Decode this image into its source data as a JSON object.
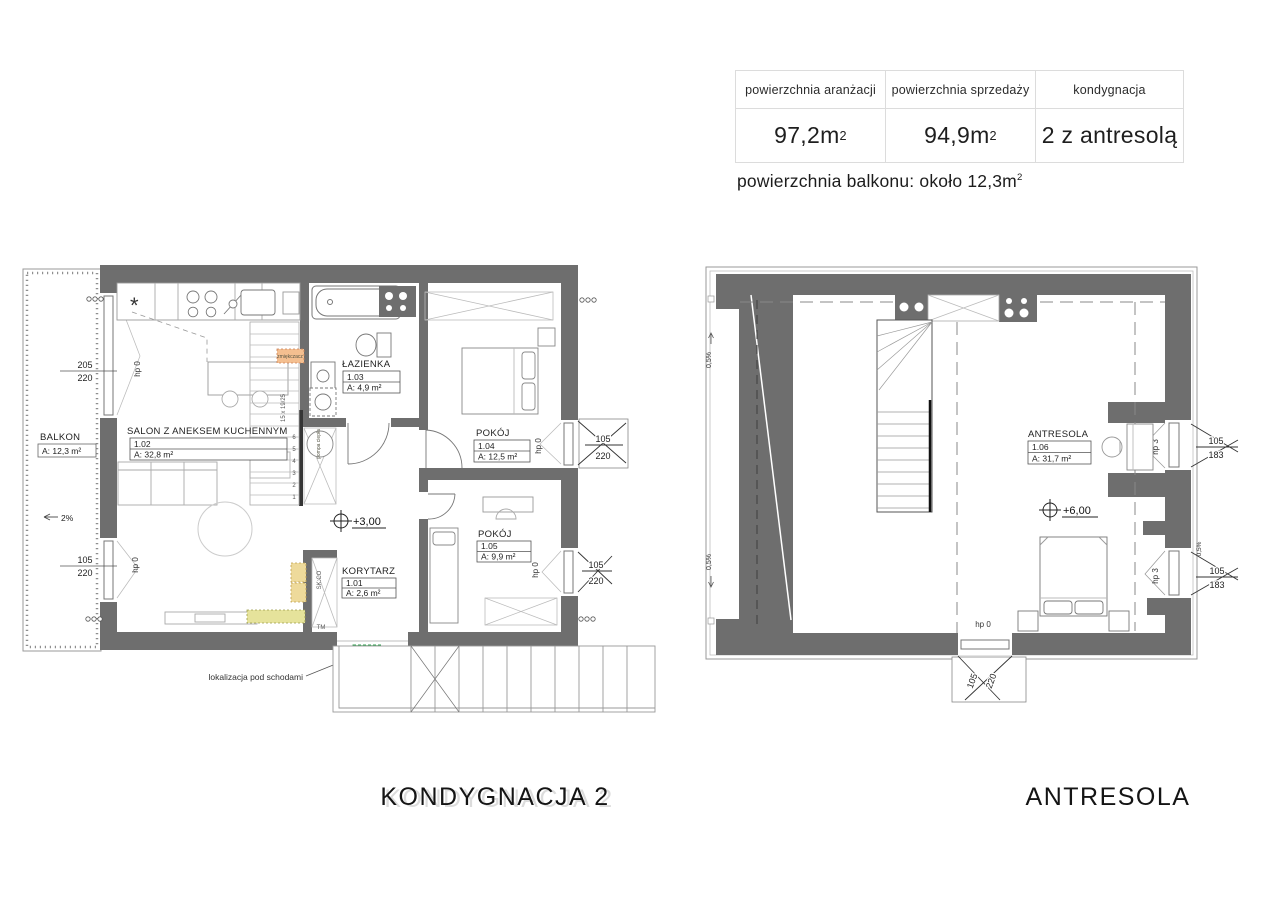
{
  "summary": {
    "headers": [
      "powierzchnia aranżacji",
      "powierzchnia sprzedaży",
      "kondygnacja"
    ],
    "values": [
      {
        "base": "97,2m",
        "sup": "2"
      },
      {
        "base": "94,9m",
        "sup": "2"
      },
      {
        "base": "2 z antresolą",
        "sup": ""
      }
    ],
    "note": {
      "base": "powierzchnia balkonu: około 12,3m",
      "sup": "2"
    }
  },
  "floor2": {
    "title": "KONDYGNACJA 2",
    "level": "+3,00",
    "balkon": {
      "name": "BALKON",
      "area": "A: 12,3 m²"
    },
    "slope": "2%",
    "salon": {
      "name": "SALON Z ANEKSEM KUCHENNYM",
      "no": "1.02",
      "area": "A: 32,8 m²"
    },
    "lazienka": {
      "name": "ŁAZIENKA",
      "no": "1.03",
      "area": "A: 4,9 m²"
    },
    "pokoj104": {
      "name": "POKÓJ",
      "no": "1.04",
      "area": "A: 12,5 m²"
    },
    "pokoj105": {
      "name": "POKÓJ",
      "no": "1.05",
      "area": "A: 9,9 m²"
    },
    "korytarz": {
      "name": "KORYTARZ",
      "no": "1.01",
      "area": "A: 2,6 m²"
    },
    "stair_note": "15 x 19/25",
    "stair_numbers": [
      "1",
      "2",
      "3",
      "4",
      "5",
      "6"
    ],
    "under_stairs": "lokalizacja pod schodami",
    "heat_pump": "pompa ciepła",
    "softener": "zmiękczacz",
    "closet": "SK:CO",
    "tm": "TM",
    "fridge": "*",
    "win_left_top": {
      "w": "205",
      "h": "220",
      "hp": "hp 0"
    },
    "win_left_bottom": {
      "w": "105",
      "h": "220",
      "hp": "hp 0"
    },
    "win_right_top": {
      "w": "105",
      "h": "220",
      "hp": "hp 0"
    },
    "win_right_bottom": {
      "w": "105",
      "h": "220",
      "hp": "hp 0"
    }
  },
  "antresola": {
    "title": "ANTRESOLA",
    "level": "+6,00",
    "room": {
      "name": "ANTRESOLA",
      "no": "1.06",
      "area": "A: 31,7 m²"
    },
    "slope1": "0,5%",
    "slope2": "0,5%",
    "slope3": "0,5%",
    "win_right_top": {
      "w": "105",
      "h": "183",
      "hp": "hp 3"
    },
    "win_right_bottom": {
      "w": "105",
      "h": "183",
      "hp": "hp 3"
    },
    "win_bottom": {
      "w": "105",
      "h": "220",
      "hp": "hp 0"
    }
  }
}
